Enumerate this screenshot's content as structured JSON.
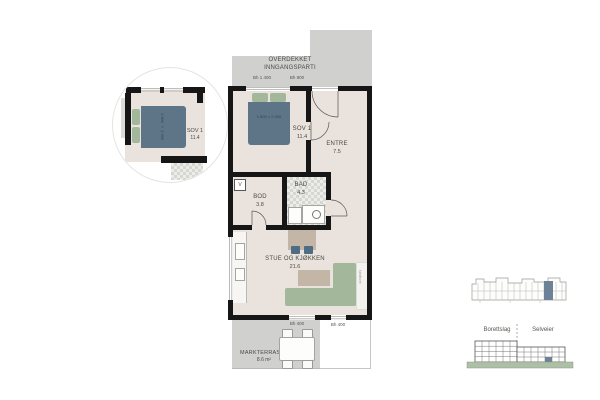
{
  "plan": {
    "covered_entrance": {
      "line1": "OVERDEKKET",
      "line2": "INNGANGSPARTI",
      "bh_left": "Bh 1 400",
      "bh_right": "Bh 800"
    },
    "rooms": {
      "sov1": {
        "name": "SOV 1",
        "area": "11.4"
      },
      "entre": {
        "name": "ENTRE",
        "area": "7.5"
      },
      "bod": {
        "name": "BOD",
        "area": "3.8"
      },
      "bad": {
        "name": "BAD",
        "area": "4.3"
      },
      "stue": {
        "name": "STUE OG KJØKKEN",
        "area": "21.6"
      },
      "terrace": {
        "name": "MARKTERRASSE",
        "area": "8.6 m²"
      }
    },
    "bed_size": "1 600 × 2 000",
    "vent_label": "V",
    "terrace_bh_left": "Bh 400",
    "terrace_bh_right": "Bh 400",
    "wall_note": "Nedforet"
  },
  "detail": {
    "room": {
      "name": "SOV 1",
      "area": "11.4"
    },
    "bed_size": "1 600 × 2 000"
  },
  "overview": {
    "left_section": "Borettslag",
    "right_section": "Selveier"
  },
  "colors": {
    "floor": "#eae2dc",
    "wall": "#161616",
    "covered_area": "#d0d0ce",
    "bed": "#5e7587",
    "sofa_green": "#a3b89b",
    "chair_blue": "#4e6d85",
    "table_tan": "#c4b6a6",
    "ground_green": "#aebfa8",
    "unit_highlight": "#6d8296"
  }
}
